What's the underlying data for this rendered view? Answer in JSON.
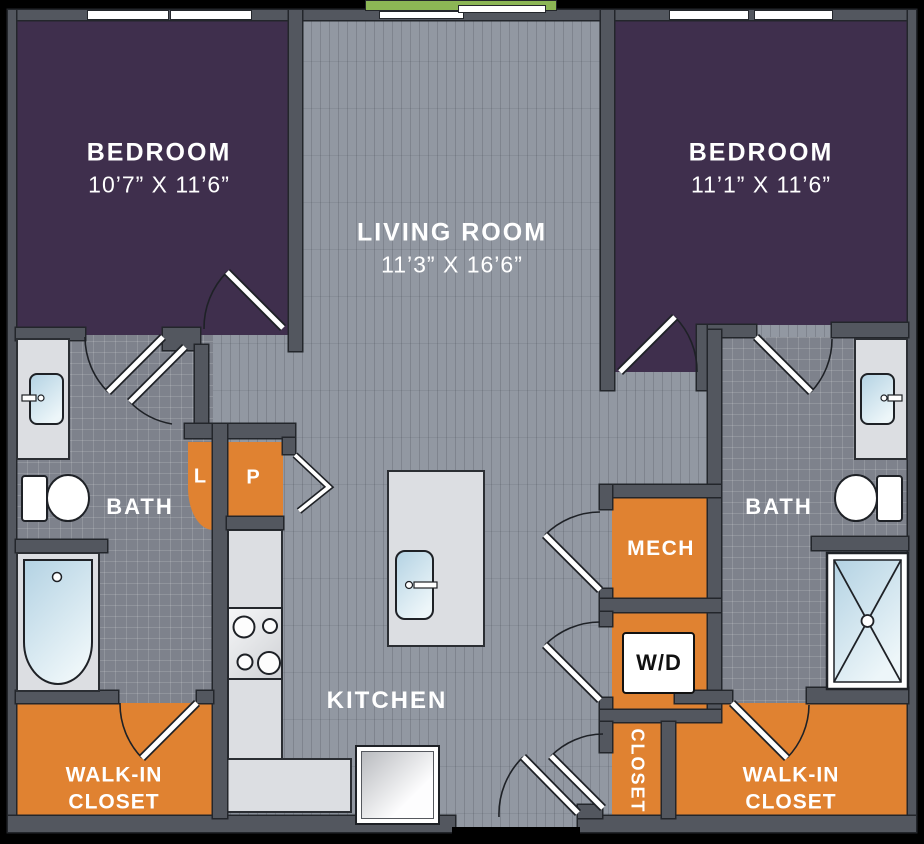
{
  "title": "Two bedroom two bath apartment floor plan",
  "colors": {
    "bedroom": "#3f2f4d",
    "wall": "#53575f",
    "outline": "#23262b",
    "floor": "#9298a2",
    "tile": "#7e828c",
    "closet_orange": "#e08231",
    "counter": "#dcdee2",
    "balcony_green": "#8cb655",
    "fixture_blue": "#b3d2e3",
    "fixture_blue_light": "#edf6f9",
    "label_text": "#ffffff"
  },
  "rooms": {
    "bedroom1": {
      "name": "BEDROOM",
      "dims": "10’7” X 11’6”"
    },
    "bedroom2": {
      "name": "BEDROOM",
      "dims": "11’1” X 11’6”"
    },
    "living": {
      "name": "LIVING ROOM",
      "dims": "11’3” X 16’6”"
    },
    "kitchen": {
      "name": "KITCHEN"
    },
    "bath1": {
      "name": "BATH"
    },
    "bath2": {
      "name": "BATH"
    },
    "mech": {
      "name": "MECH"
    },
    "washer_dryer": {
      "name": "W/D"
    },
    "closet": {
      "name": "CLOSET"
    },
    "walk_in_closet1": {
      "line1": "WALK-IN",
      "line2": "CLOSET"
    },
    "walk_in_closet2": {
      "line1": "WALK-IN",
      "line2": "CLOSET"
    },
    "linen": {
      "name": "L"
    },
    "pantry": {
      "name": "P"
    }
  }
}
